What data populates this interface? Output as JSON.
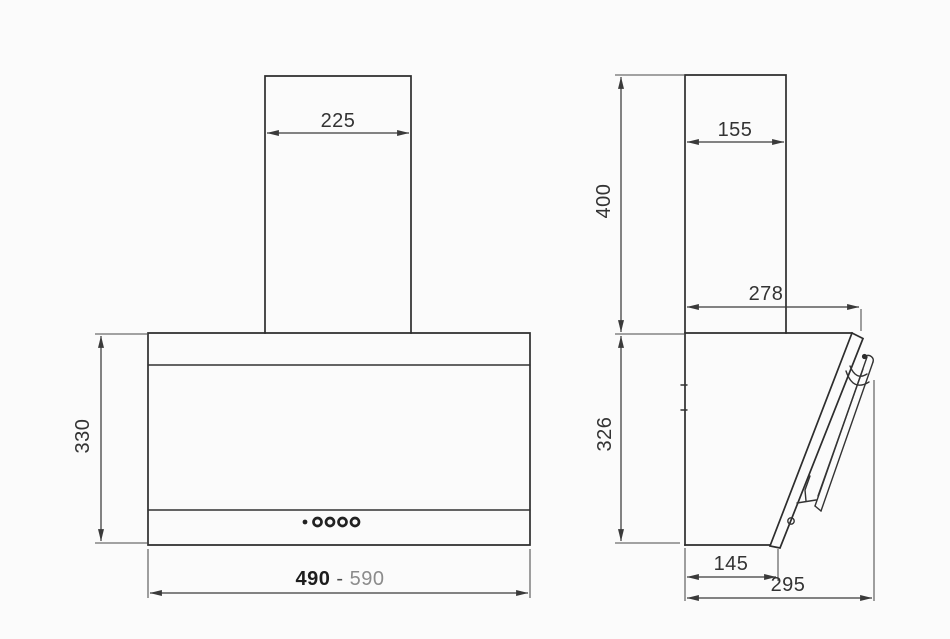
{
  "drawing": {
    "description_labels": {
      "front_view": {
        "chimney_width": "225",
        "body_height": "330",
        "width_min": "490",
        "width_separator": " - ",
        "width_max": "590"
      },
      "side_view": {
        "chimney_depth": "155",
        "chimney_height": "400",
        "top_depth": "278",
        "body_height": "326",
        "bottom_depth": "145",
        "total_depth": "295"
      }
    },
    "colors": {
      "background": "#fbfbfb",
      "object_line": "#2d2d2d",
      "dimension_line": "#3a3a3a",
      "label_text": "#333333",
      "label_secondary": "#8b8b8b"
    }
  }
}
